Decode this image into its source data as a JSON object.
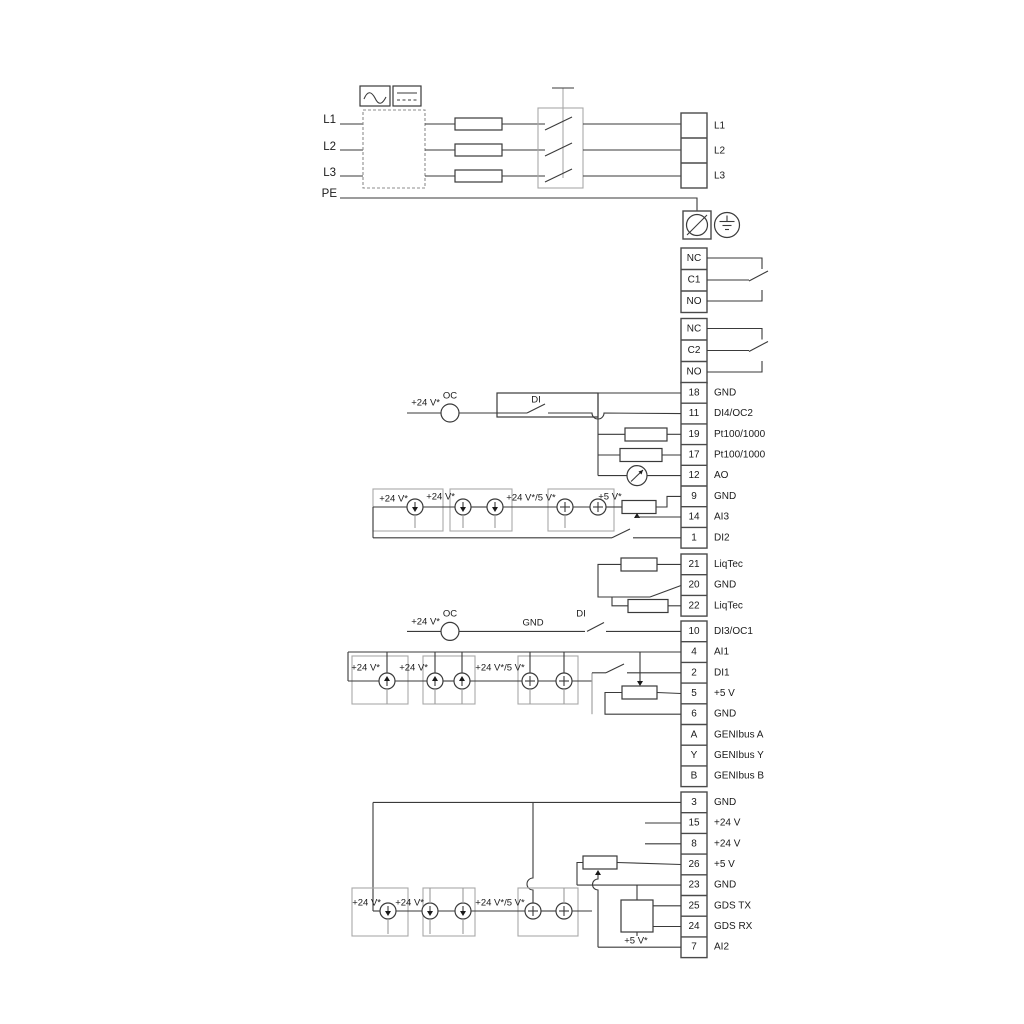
{
  "diagram": {
    "mains_in": {
      "l1": "L1",
      "l2": "L2",
      "l3": "L3",
      "pe": "PE"
    },
    "mains_out": {
      "l1": "L1",
      "l2": "L2",
      "l3": "L3"
    },
    "relay1": {
      "nc": "NC",
      "c": "C1",
      "no": "NO"
    },
    "relay2": {
      "nc": "NC",
      "c": "C2",
      "no": "NO"
    },
    "strip1": {
      "rows": [
        {
          "num": "18",
          "label": "GND"
        },
        {
          "num": "11",
          "label": "DI4/OC2"
        },
        {
          "num": "19",
          "label": "Pt100/1000"
        },
        {
          "num": "17",
          "label": "Pt100/1000"
        },
        {
          "num": "12",
          "label": "AO"
        },
        {
          "num": "9",
          "label": "GND"
        },
        {
          "num": "14",
          "label": "AI3"
        },
        {
          "num": "1",
          "label": "DI2"
        }
      ]
    },
    "liqtec": {
      "rows": [
        {
          "num": "21",
          "label": "LiqTec"
        },
        {
          "num": "20",
          "label": "GND"
        },
        {
          "num": "22",
          "label": "LiqTec"
        }
      ]
    },
    "strip2": {
      "rows": [
        {
          "num": "10",
          "label": "DI3/OC1"
        },
        {
          "num": "4",
          "label": "AI1"
        },
        {
          "num": "2",
          "label": "DI1"
        },
        {
          "num": "5",
          "label": "+5 V"
        },
        {
          "num": "6",
          "label": "GND"
        },
        {
          "num": "A",
          "label": "GENIbus A"
        },
        {
          "num": "Y",
          "label": "GENIbus Y"
        },
        {
          "num": "B",
          "label": "GENIbus B"
        }
      ]
    },
    "strip3": {
      "rows": [
        {
          "num": "3",
          "label": "GND"
        },
        {
          "num": "15",
          "label": "+24 V"
        },
        {
          "num": "8",
          "label": "+24 V"
        },
        {
          "num": "26",
          "label": "+5 V"
        },
        {
          "num": "23",
          "label": "GND"
        },
        {
          "num": "25",
          "label": "GDS TX"
        },
        {
          "num": "24",
          "label": "GDS RX"
        },
        {
          "num": "7",
          "label": "AI2"
        }
      ]
    },
    "annot": {
      "oc_row1": {
        "v24": "+24 V*",
        "oc": "OC",
        "di": "DI"
      },
      "ai3_row": {
        "v24a": "+24 V*",
        "v24b": "+24 V*",
        "v24_5": "+24 V*/5 V*",
        "v5": "+5 V*"
      },
      "oc_row2": {
        "v24": "+24 V*",
        "oc": "OC",
        "gnd": "GND",
        "di": "DI"
      },
      "ai1_row": {
        "v24a": "+24 V*",
        "v24b": "+24 V*",
        "v24_5": "+24 V*/5 V*"
      },
      "ai2_row": {
        "v24a": "+24 V*",
        "v24b": "+24 V*",
        "v24_5": "+24 V*/5 V*",
        "v5": "+5 V*"
      }
    }
  }
}
